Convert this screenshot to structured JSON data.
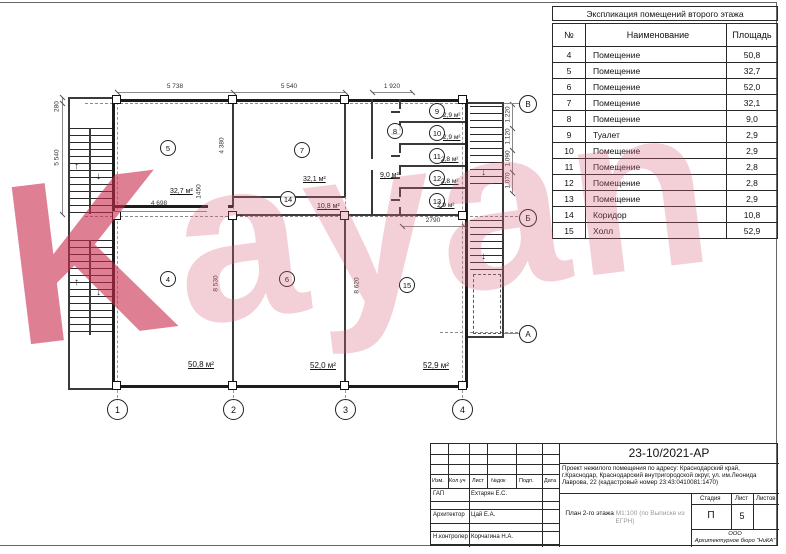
{
  "watermark": {
    "text": "Kayan",
    "color_k": "rgba(201,42,77,0.60)",
    "color_rest": "rgba(216,100,126,0.30)"
  },
  "table": {
    "title": "Экспликация помещений второго этажа",
    "headers": {
      "num": "№",
      "name": "Наименование",
      "area": "Площадь"
    },
    "rows": [
      {
        "num": "4",
        "name": "Помещение",
        "area": "50,8"
      },
      {
        "num": "5",
        "name": "Помещение",
        "area": "32,7"
      },
      {
        "num": "6",
        "name": "Помещение",
        "area": "52,0"
      },
      {
        "num": "7",
        "name": "Помещение",
        "area": "32,1"
      },
      {
        "num": "8",
        "name": "Помещение",
        "area": "9,0"
      },
      {
        "num": "9",
        "name": "Туалет",
        "area": "2,9"
      },
      {
        "num": "10",
        "name": "Помещение",
        "area": "2,9"
      },
      {
        "num": "11",
        "name": "Помещение",
        "area": "2,8"
      },
      {
        "num": "12",
        "name": "Помещение",
        "area": "2,8"
      },
      {
        "num": "13",
        "name": "Помещение",
        "area": "2,9"
      },
      {
        "num": "14",
        "name": "Коридор",
        "area": "10,8"
      },
      {
        "num": "15",
        "name": "Холл",
        "area": "52,9"
      }
    ]
  },
  "plan": {
    "rooms": [
      {
        "id": "4",
        "area": "50,8 м²"
      },
      {
        "id": "5",
        "area": "32,7 м²"
      },
      {
        "id": "6",
        "area": "52,0 м²"
      },
      {
        "id": "7",
        "area": "32,1 м²"
      },
      {
        "id": "8",
        "area": "9,0 м²"
      },
      {
        "id": "9",
        "area": "2,9 м²"
      },
      {
        "id": "10",
        "area": "2,9 м²"
      },
      {
        "id": "11",
        "area": "2,8 м²"
      },
      {
        "id": "12",
        "area": "2,8 м²"
      },
      {
        "id": "13",
        "area": "2,9 м²"
      },
      {
        "id": "14",
        "area": "10,8 м²"
      },
      {
        "id": "15",
        "area": "52,9 м²"
      }
    ],
    "dims": {
      "top": [
        "5 738",
        "5 540",
        "1 920"
      ],
      "left": [
        "280",
        "5 540"
      ],
      "right": [
        "1.220",
        "1.120",
        "1.090",
        "1.070"
      ],
      "inner": {
        "d4380": "4 380",
        "d4698": "4 698",
        "d1450": "1450",
        "d8530": "8 530",
        "d8620": "8 620",
        "d2790": "2790"
      }
    },
    "axes": {
      "cols": [
        "1",
        "2",
        "3",
        "4"
      ],
      "rows": [
        "В",
        "Б",
        "А"
      ]
    }
  },
  "titleblock": {
    "doc_number": "23-10/2021-АР",
    "description": "Проект  нежилого помещения по адресу: Краснодарский край, г.Краснодар, Краснодарский внутригородской округ, ул. им.Леонида Лаврова, 22 (кадастровый номер 23:43:0410081:1470)",
    "cols": [
      "Изм.",
      "Кол.уч",
      "Лист",
      "№док",
      "Подп.",
      "Дата"
    ],
    "roles": [
      {
        "role": "ГАП",
        "name": "Ехтарян Е.С."
      },
      {
        "role": "Архитектор",
        "name": "Цай Е.А."
      },
      {
        "role": "Н.контролер",
        "name": "Корчагина Н.А."
      }
    ],
    "drawing_title": "План 2-го этажа",
    "drawing_note": "М1:100 (по Выписке из ЕГРН)",
    "stage_label": "Стадия",
    "sheet_label": "Лист",
    "sheets_label": "Листов",
    "stage": "П",
    "sheet": "5",
    "sheets": "",
    "company": "ООО\nАрхитектурное бюро \"НиКА\""
  }
}
